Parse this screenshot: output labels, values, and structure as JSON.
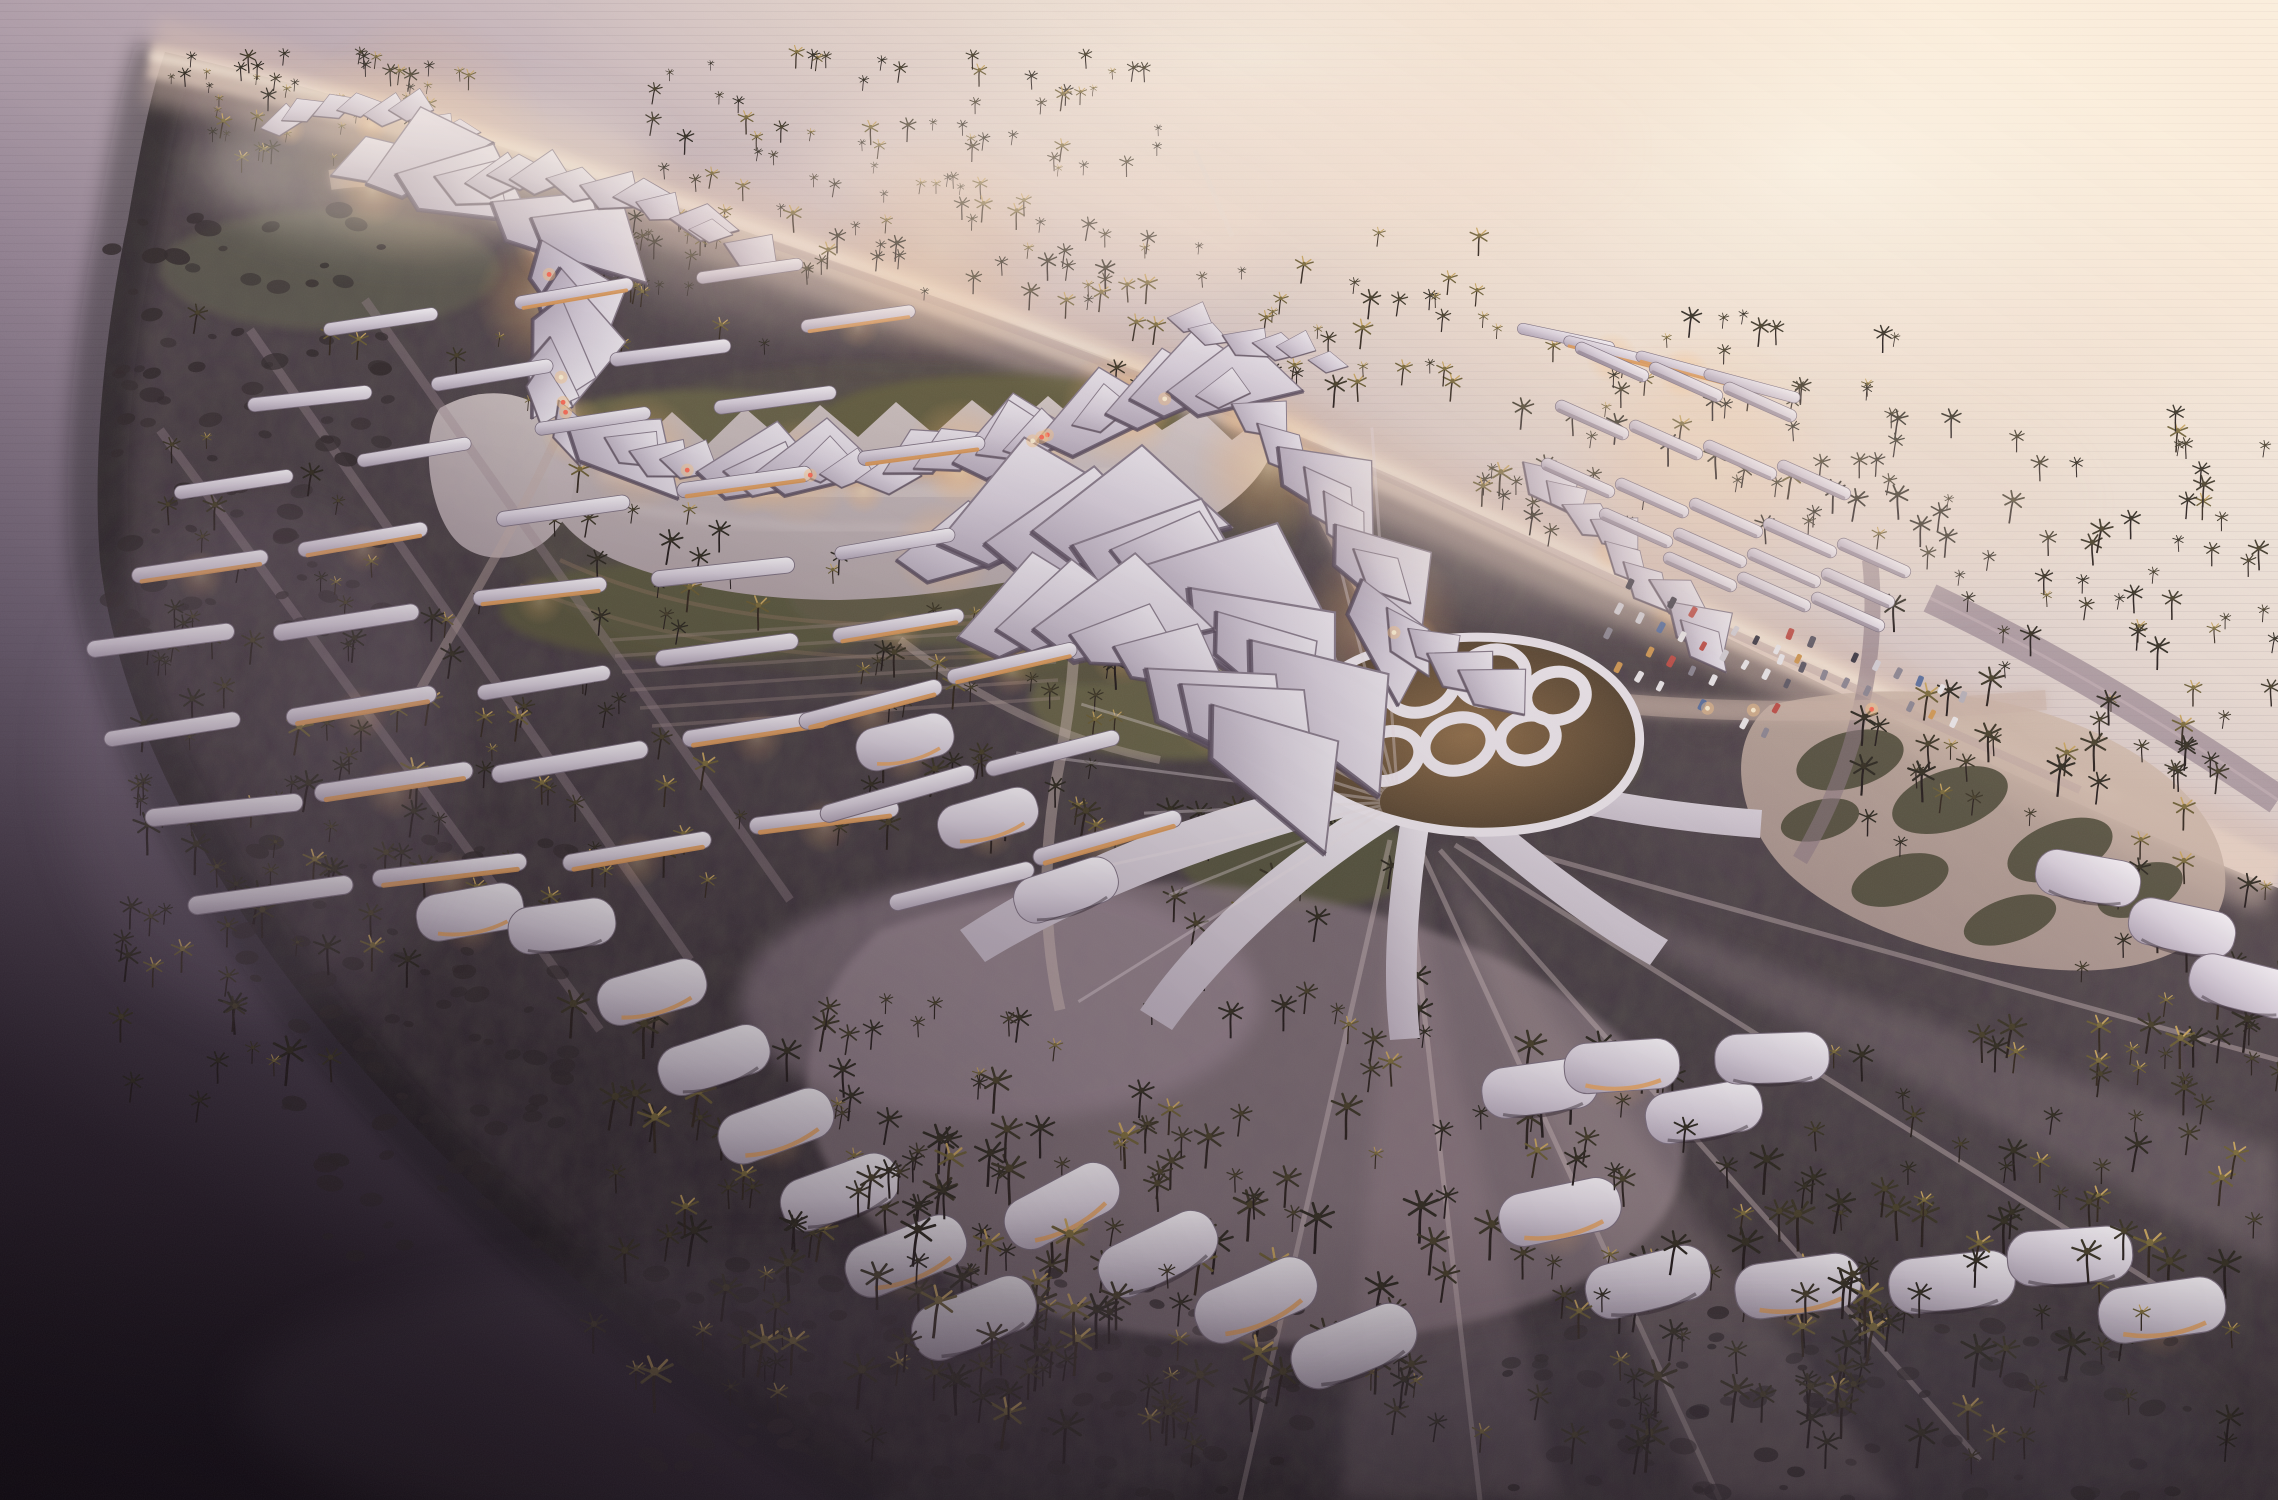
{
  "meta": {
    "type": "architectural-aerial-rendering",
    "subject": "coastal resort masterplan with parametric white canopy structures, palm forest, lagoon, glowing roads, beach and sea at dusk",
    "view": "aerial-oblique",
    "time_of_day": "dusk"
  },
  "palette": {
    "sea_bright": "#fdf6e9",
    "sea_mid": "#9d8c9c",
    "sea_dark": "#150f16",
    "sand": "#e5cdbd",
    "land_light": "#6a5a5e",
    "land_dark": "#241c24",
    "canopy": "#f2eef3",
    "canopy_shade": "#b3a7b8",
    "glow_warm": "#ffca87",
    "road_glow": "#f0ae74",
    "lawn": "#6e6a49",
    "pond": "#cfc2c4",
    "palm_dark": "#2c2820",
    "palm_lit": "#c8a55e",
    "plaza": "#8b7a82"
  },
  "scene": {
    "canopy_chains": [
      {
        "points": [
          [
            248,
            132
          ],
          [
            300,
            116
          ],
          [
            352,
            110
          ],
          [
            402,
            116
          ],
          [
            442,
            130
          ]
        ],
        "step": 26,
        "size": [
          0.45,
          0.75
        ],
        "seed": 11,
        "glow": true
      },
      {
        "points": [
          [
            318,
            182
          ],
          [
            392,
            174
          ],
          [
            462,
            186
          ],
          [
            528,
            214
          ],
          [
            562,
            262
          ],
          [
            560,
            318
          ],
          [
            546,
            372
          ],
          [
            562,
            422
          ],
          [
            622,
            452
          ],
          [
            700,
            468
          ],
          [
            780,
            476
          ],
          [
            860,
            477
          ],
          [
            932,
            467
          ],
          [
            1002,
            449
          ],
          [
            1062,
            429
          ],
          [
            1112,
            407
          ],
          [
            1162,
            392
          ],
          [
            1212,
            396
          ],
          [
            1256,
            422
          ],
          [
            1292,
            458
          ],
          [
            1322,
            498
          ],
          [
            1348,
            542
          ],
          [
            1372,
            586
          ],
          [
            1400,
            626
          ],
          [
            1434,
            656
          ],
          [
            1474,
            678
          ]
        ],
        "step": 33,
        "size": [
          0.8,
          1.5
        ],
        "seed": 23,
        "glow": true
      },
      {
        "points": [
          [
            470,
            170
          ],
          [
            540,
            178
          ],
          [
            610,
            196
          ],
          [
            680,
            220
          ],
          [
            740,
            248
          ]
        ],
        "step": 30,
        "size": [
          0.6,
          1.0
        ],
        "seed": 31,
        "glow": false
      },
      {
        "points": [
          [
            1508,
            452
          ],
          [
            1548,
            486
          ],
          [
            1588,
            522
          ],
          [
            1626,
            558
          ],
          [
            1662,
            596
          ],
          [
            1690,
            634
          ]
        ],
        "step": 30,
        "size": [
          0.7,
          1.2
        ],
        "seed": 41,
        "glow": true
      },
      {
        "points": [
          [
            880,
            560
          ],
          [
            950,
            540
          ],
          [
            1020,
            530
          ],
          [
            1090,
            540
          ],
          [
            1160,
            570
          ],
          [
            1220,
            610
          ],
          [
            1270,
            655
          ]
        ],
        "step": 42,
        "size": [
          1.3,
          2.2
        ],
        "seed": 53,
        "glow": true
      },
      {
        "points": [
          [
            930,
            640
          ],
          [
            1000,
            625
          ],
          [
            1070,
            630
          ],
          [
            1140,
            655
          ],
          [
            1200,
            690
          ],
          [
            1250,
            730
          ]
        ],
        "step": 44,
        "size": [
          1.2,
          2.0
        ],
        "seed": 67,
        "glow": true
      },
      {
        "points": [
          [
            1150,
            318
          ],
          [
            1205,
            330
          ],
          [
            1260,
            345
          ],
          [
            1315,
            362
          ]
        ],
        "step": 30,
        "size": [
          0.5,
          0.8
        ],
        "seed": 71,
        "glow": false
      }
    ],
    "pavilion_rows": [
      {
        "x": 388,
        "y": 318,
        "n": 3,
        "seed": 101
      },
      {
        "x": 306,
        "y": 398,
        "n": 4,
        "seed": 102
      },
      {
        "x": 238,
        "y": 478,
        "n": 4,
        "seed": 103
      },
      {
        "x": 190,
        "y": 560,
        "n": 5,
        "seed": 104
      },
      {
        "x": 168,
        "y": 643,
        "n": 5,
        "seed": 105
      },
      {
        "x": 178,
        "y": 727,
        "n": 5,
        "seed": 106
      },
      {
        "x": 215,
        "y": 812,
        "n": 4,
        "seed": 107
      },
      {
        "x": 272,
        "y": 897,
        "n": 4,
        "seed": 108
      },
      {
        "x": 862,
        "y": 700,
        "n": 2,
        "dx": 150,
        "rot": -14,
        "seed": 109
      },
      {
        "x": 905,
        "y": 790,
        "n": 2,
        "dx": 150,
        "rot": -15,
        "seed": 110
      },
      {
        "x": 952,
        "y": 882,
        "n": 2,
        "dx": 150,
        "rot": -16,
        "seed": 111
      }
    ],
    "beach_bars": [
      [
        1566,
        338,
        12,
        0
      ],
      [
        1612,
        352,
        14,
        1
      ],
      [
        1684,
        368,
        15,
        1
      ],
      [
        1752,
        386,
        15,
        0
      ]
    ],
    "carport_rows": [
      {
        "x": 1612,
        "y": 362,
        "n": 3
      },
      {
        "x": 1592,
        "y": 420,
        "n": 4
      },
      {
        "x": 1578,
        "y": 478,
        "n": 5
      },
      {
        "x": 1636,
        "y": 528,
        "n": 4
      },
      {
        "x": 1700,
        "y": 572,
        "n": 3
      }
    ],
    "pavilions": [
      [
        470,
        912,
        -10,
        1
      ],
      [
        562,
        926,
        -8,
        0
      ],
      [
        652,
        992,
        -16,
        1
      ],
      [
        714,
        1060,
        -18,
        0
      ],
      [
        776,
        1126,
        -20,
        1
      ],
      [
        840,
        1192,
        -20,
        0
      ],
      [
        906,
        1256,
        -22,
        1
      ],
      [
        974,
        1318,
        -22,
        0
      ],
      [
        1062,
        1206,
        -28,
        1
      ],
      [
        1158,
        1254,
        -26,
        0
      ],
      [
        1256,
        1300,
        -24,
        1
      ],
      [
        1354,
        1346,
        -22,
        0
      ],
      [
        905,
        742,
        -14,
        1
      ],
      [
        988,
        818,
        -16,
        1
      ],
      [
        1066,
        890,
        -18,
        0
      ],
      [
        1540,
        1088,
        -8,
        0
      ],
      [
        1622,
        1066,
        -4,
        1
      ],
      [
        1704,
        1112,
        -10,
        0
      ],
      [
        1772,
        1058,
        -2,
        0
      ],
      [
        1560,
        1212,
        -12,
        1
      ],
      [
        1648,
        1282,
        -14,
        0
      ],
      [
        1798,
        1286,
        -8,
        1
      ],
      [
        1952,
        1282,
        -6,
        0
      ],
      [
        2070,
        1256,
        -4,
        0
      ],
      [
        2162,
        1310,
        -8,
        1
      ],
      [
        2088,
        878,
        10,
        0
      ],
      [
        2182,
        928,
        12,
        0
      ],
      [
        2244,
        986,
        14,
        0
      ]
    ],
    "parking": [
      {
        "x": 1630,
        "y": 584,
        "rows": 4,
        "cols": 9,
        "dx": 23,
        "dy": 27,
        "rot": 24,
        "seed": 5
      },
      {
        "x": 1790,
        "y": 634,
        "rows": 2,
        "cols": 9,
        "dx": 23,
        "dy": 27,
        "rot": 20,
        "seed": 9
      }
    ],
    "road_points": [
      [
        330,
        180
      ],
      [
        420,
        170
      ],
      [
        500,
        200
      ],
      [
        545,
        260
      ],
      [
        565,
        330
      ],
      [
        560,
        390
      ],
      [
        570,
        430
      ],
      [
        640,
        465
      ],
      [
        760,
        478
      ],
      [
        900,
        470
      ],
      [
        1030,
        442
      ],
      [
        1120,
        405
      ],
      [
        1200,
        394
      ],
      [
        1256,
        422
      ],
      [
        1300,
        470
      ],
      [
        1330,
        530
      ],
      [
        1360,
        590
      ],
      [
        1400,
        640
      ],
      [
        1450,
        668
      ],
      [
        1530,
        694
      ],
      [
        1650,
        706
      ],
      [
        1800,
        712
      ],
      [
        1960,
        706
      ],
      [
        2080,
        696
      ]
    ],
    "road_light_count": 14,
    "car_colors": [
      "#ece8ea",
      "#d5d0d6",
      "#b8b2ba",
      "#8e8894",
      "#615c68",
      "#403c48",
      "#c05049",
      "#5d72a0",
      "#d29a55"
    ],
    "glow_spots": [
      [
        545,
        300,
        70
      ],
      [
        640,
        452,
        60
      ],
      [
        800,
        472,
        55
      ],
      [
        960,
        452,
        55
      ],
      [
        1120,
        408,
        60
      ],
      [
        1268,
        468,
        75
      ],
      [
        1380,
        622,
        85
      ],
      [
        1370,
        716,
        60
      ],
      [
        1462,
        696,
        48
      ],
      [
        1424,
        782,
        42
      ],
      [
        420,
        142,
        130
      ],
      [
        940,
        250,
        120
      ],
      [
        1700,
        470,
        140
      ]
    ],
    "radial_fan": {
      "cx": 1398,
      "cy": 802,
      "count": 13,
      "a0": 148,
      "a1": 266,
      "len": [
        240,
        430
      ]
    },
    "palm_clusters": [
      {
        "x": 170,
        "y": 64,
        "w": 300,
        "h": 110,
        "n": 55,
        "seed": 1,
        "lit": 0.5
      },
      {
        "x": 600,
        "y": 64,
        "w": 560,
        "h": 250,
        "n": 120,
        "seed": 2,
        "lit": 0.35
      },
      {
        "x": 1060,
        "y": 240,
        "w": 440,
        "h": 170,
        "n": 50,
        "seed": 3,
        "lit": 0.4
      },
      {
        "x": 1470,
        "y": 320,
        "w": 430,
        "h": 230,
        "n": 60,
        "seed": 4,
        "lit": 0.35
      },
      {
        "x": 1840,
        "y": 430,
        "w": 438,
        "h": 430,
        "n": 85,
        "seed": 5,
        "lit": 0.15
      },
      {
        "x": 2080,
        "y": 770,
        "w": 198,
        "h": 340,
        "n": 32,
        "seed": 6,
        "lit": 0.2
      },
      {
        "x": 560,
        "y": 1010,
        "w": 880,
        "h": 460,
        "n": 150,
        "seed": 7,
        "lit": 0.25
      },
      {
        "x": 1430,
        "y": 1050,
        "w": 840,
        "h": 430,
        "n": 120,
        "seed": 8,
        "lit": 0.2
      },
      {
        "x": 150,
        "y": 330,
        "w": 620,
        "h": 620,
        "n": 85,
        "seed": 9,
        "lit": 0.3
      },
      {
        "x": 820,
        "y": 560,
        "w": 340,
        "h": 320,
        "n": 45,
        "seed": 10,
        "lit": 0.35
      },
      {
        "x": 1160,
        "y": 820,
        "w": 300,
        "h": 230,
        "n": 20,
        "seed": 11,
        "lit": 0.3
      },
      {
        "x": 120,
        "y": 620,
        "w": 320,
        "h": 520,
        "n": 60,
        "seed": 12,
        "lit": 0.15
      },
      {
        "x": 700,
        "y": 1150,
        "w": 500,
        "h": 300,
        "n": 40,
        "seed": 21,
        "lit": 0.3,
        "fg": true
      },
      {
        "x": 1550,
        "y": 1150,
        "w": 600,
        "h": 300,
        "n": 35,
        "seed": 22,
        "lit": 0.25,
        "fg": true
      }
    ],
    "shrub_clusters": [
      {
        "x": 110,
        "y": 210,
        "w": 280,
        "h": 430,
        "n": 90,
        "seed": 13
      },
      {
        "x": 240,
        "y": 840,
        "w": 340,
        "h": 420,
        "n": 80,
        "seed": 14
      },
      {
        "x": 640,
        "y": 1260,
        "w": 700,
        "h": 240,
        "n": 90,
        "seed": 15
      },
      {
        "x": 1500,
        "y": 1300,
        "w": 700,
        "h": 200,
        "n": 70,
        "seed": 16
      }
    ]
  }
}
